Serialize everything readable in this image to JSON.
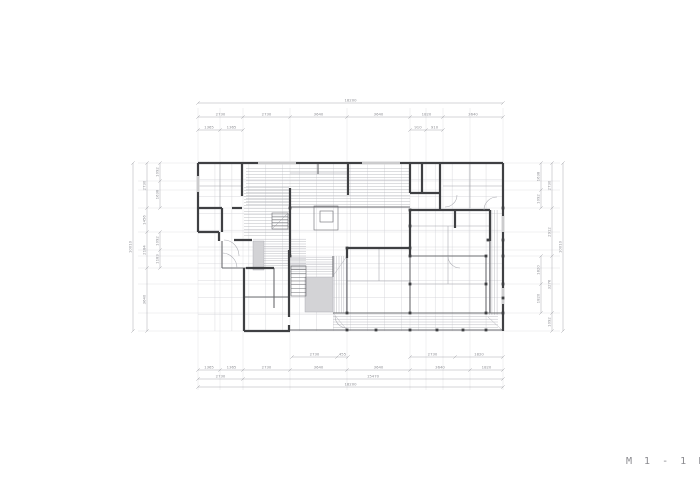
{
  "title": {
    "label": "M 1 - 1 F"
  },
  "colors": {
    "wall": "#3f4043",
    "medium": "#6b6c70",
    "thin": "#a3a4aa",
    "grid": "#cfd0d6",
    "ext": "#dcdce0",
    "hatch": "#b3b4ba",
    "gray_fill": "#d3d3d6",
    "dim": "#a0a1a7",
    "dim_text": "#8e8f95",
    "arc": "#a8a9af",
    "bg": "#ffffff"
  },
  "plan": {
    "grid": {
      "x0": 198,
      "y0": 163,
      "x1": 503,
      "y1": 331,
      "cols": 18,
      "rows": 10
    },
    "ext": {
      "xs": [
        198,
        220,
        243,
        290,
        347,
        410,
        426,
        443,
        470,
        503
      ],
      "ys": [
        163,
        181,
        190,
        208,
        232,
        250,
        256,
        268,
        284,
        313,
        331
      ],
      "ytop": 108,
      "ybot": 390,
      "xleft": 138,
      "xright": 560
    },
    "walls": [
      [
        198,
        163,
        503,
        163
      ],
      [
        198,
        163,
        198,
        232
      ],
      [
        198,
        232,
        219,
        232
      ],
      [
        219,
        232,
        219,
        241
      ],
      [
        234,
        240,
        252,
        240
      ],
      [
        244,
        268,
        244,
        331
      ],
      [
        244,
        331,
        290,
        331
      ],
      [
        503,
        163,
        503,
        331
      ],
      [
        242,
        163,
        242,
        196
      ],
      [
        198,
        208,
        222,
        208
      ],
      [
        232,
        208,
        242,
        208
      ],
      [
        222,
        208,
        222,
        232
      ],
      [
        290,
        188,
        290,
        257
      ],
      [
        246,
        268,
        274,
        268
      ],
      [
        289,
        250,
        289,
        317
      ],
      [
        289,
        325,
        289,
        331
      ],
      [
        348,
        163,
        348,
        195
      ],
      [
        410,
        163,
        410,
        193
      ],
      [
        410,
        193,
        440,
        193
      ],
      [
        422,
        163,
        422,
        193
      ],
      [
        440,
        163,
        440,
        210
      ],
      [
        410,
        210,
        490,
        210
      ],
      [
        410,
        210,
        410,
        257
      ],
      [
        455,
        210,
        455,
        228
      ],
      [
        490,
        210,
        490,
        241
      ],
      [
        347,
        248,
        410,
        248
      ],
      [
        347,
        248,
        347,
        258
      ]
    ],
    "medium": [
      [
        318,
        163,
        318,
        174
      ],
      [
        274,
        268,
        274,
        308
      ],
      [
        222,
        241,
        222,
        268
      ],
      [
        222,
        268,
        246,
        268
      ],
      [
        244,
        297,
        289,
        297
      ],
      [
        290,
        330,
        503,
        330
      ],
      [
        333,
        313,
        503,
        313
      ],
      [
        410,
        256,
        486,
        256
      ],
      [
        410,
        256,
        410,
        313
      ],
      [
        486,
        256,
        486,
        313
      ],
      [
        347,
        256,
        347,
        313
      ],
      [
        333,
        256,
        333,
        277
      ],
      [
        290,
        207,
        410,
        207
      ],
      [
        490,
        241,
        490,
        313
      ]
    ],
    "thin": [
      [
        220,
        163,
        220,
        208
      ],
      [
        198,
        186,
        242,
        186
      ],
      [
        443,
        186,
        503,
        186
      ],
      [
        470,
        163,
        470,
        208
      ],
      [
        410,
        226,
        490,
        226
      ],
      [
        448,
        226,
        448,
        256
      ],
      [
        347,
        281,
        410,
        281
      ],
      [
        379,
        248,
        379,
        281
      ],
      [
        410,
        284,
        486,
        284
      ],
      [
        448,
        256,
        448,
        284
      ],
      [
        290,
        173,
        348,
        173
      ]
    ],
    "hatches": [
      {
        "x": 246,
        "y": 167,
        "w": 164,
        "h": 39,
        "dir": "h",
        "gap": 3
      },
      {
        "x": 244,
        "y": 186,
        "w": 45,
        "h": 52,
        "dir": "h",
        "gap": 3
      },
      {
        "x": 253,
        "y": 238,
        "w": 53,
        "h": 31,
        "dir": "h",
        "gap": 2.4
      },
      {
        "x": 289,
        "y": 256,
        "w": 44,
        "h": 20,
        "dir": "h",
        "gap": 2.4
      },
      {
        "x": 333,
        "y": 256,
        "w": 14,
        "h": 57,
        "dir": "v",
        "gap": 2.4
      },
      {
        "x": 333,
        "y": 315,
        "w": 165,
        "h": 15,
        "dir": "h",
        "gap": 2.8
      },
      {
        "x": 488,
        "y": 210,
        "w": 11,
        "h": 105,
        "dir": "v",
        "gap": 2.6
      }
    ],
    "mitres": [
      [
        333,
        276,
        347,
        256
      ],
      [
        333,
        313,
        347,
        330
      ],
      [
        488,
        317,
        502,
        330
      ]
    ],
    "grays": [
      {
        "x": 253,
        "y": 241,
        "w": 11,
        "h": 29
      },
      {
        "x": 305,
        "y": 277,
        "w": 28,
        "h": 35
      }
    ],
    "stairs": {
      "main": {
        "x": 291,
        "y": 266,
        "w": 15,
        "h": 30,
        "steps": 8
      },
      "small": {
        "x": 272,
        "y": 213,
        "w": 16,
        "h": 16,
        "steps": 5
      }
    },
    "squares": [
      {
        "x": 314,
        "y": 206,
        "w": 24,
        "h": 24
      },
      {
        "x": 320,
        "y": 211,
        "w": 13,
        "h": 11
      }
    ],
    "arcs": [
      "M224,240 A15,16 0 0 1 239,256",
      "M222,253 A15,15 0 0 1 237,268",
      "M445,207 A12,12 0 0 0 457,195",
      "M484,210 A13,13 0 0 1 497,197",
      "M448,256 A12,12 0 0 0 460,268",
      "M335,316 A12,12 0 0 0 347,328"
    ],
    "windows": [
      {
        "x": 258,
        "y": 163,
        "len": 38,
        "o": "h"
      },
      {
        "x": 362,
        "y": 163,
        "len": 38,
        "o": "h"
      },
      {
        "x": 198,
        "y": 176,
        "len": 16,
        "o": "v"
      },
      {
        "x": 503,
        "y": 216,
        "len": 16,
        "o": "v"
      },
      {
        "x": 503,
        "y": 288,
        "len": 16,
        "o": "v"
      }
    ],
    "columns": [
      [
        347,
        248
      ],
      [
        410,
        248
      ],
      [
        410,
        210
      ],
      [
        410,
        226
      ],
      [
        410,
        256
      ],
      [
        410,
        284
      ],
      [
        410,
        313
      ],
      [
        410,
        330
      ],
      [
        437,
        330
      ],
      [
        463,
        330
      ],
      [
        486,
        256
      ],
      [
        486,
        284
      ],
      [
        486,
        313
      ],
      [
        486,
        330
      ],
      [
        503,
        208
      ],
      [
        503,
        240
      ],
      [
        503,
        256
      ],
      [
        503,
        284
      ],
      [
        503,
        313
      ],
      [
        503,
        298
      ],
      [
        347,
        313
      ],
      [
        347,
        330
      ],
      [
        376,
        330
      ],
      [
        290,
        208
      ],
      [
        290,
        256
      ],
      [
        488,
        240
      ]
    ]
  },
  "dims": {
    "chains": [
      {
        "o": "h",
        "pos": 103,
        "ticks": [
          198,
          503
        ],
        "labels": [
          "18200"
        ]
      },
      {
        "o": "h",
        "pos": 117,
        "ticks": [
          198,
          243,
          290,
          347,
          410,
          443,
          503
        ],
        "labels": [
          "2730",
          "2730",
          "3640",
          "3640",
          "1820",
          "3640"
        ]
      },
      {
        "o": "h",
        "pos": 130,
        "ticks": [
          198,
          220,
          243
        ],
        "labels": [
          "1365",
          "1365"
        ]
      },
      {
        "o": "h",
        "pos": 130,
        "ticks": [
          410,
          426,
          443
        ],
        "labels": [
          "910",
          "910"
        ]
      },
      {
        "o": "h",
        "pos": 357,
        "ticks": [
          292,
          337,
          348
        ],
        "labels": [
          "2730",
          "455"
        ]
      },
      {
        "o": "h",
        "pos": 357,
        "ticks": [
          410,
          455,
          503
        ],
        "labels": [
          "2730",
          "1820"
        ]
      },
      {
        "o": "h",
        "pos": 370,
        "ticks": [
          198,
          220,
          243,
          290,
          347,
          410,
          470,
          503
        ],
        "labels": [
          "1365",
          "1365",
          "2730",
          "3640",
          "3640",
          "3640",
          "1820"
        ]
      },
      {
        "o": "h",
        "pos": 379,
        "ticks": [
          198,
          243,
          503
        ],
        "labels": [
          "2730",
          "15470"
        ]
      },
      {
        "o": "h",
        "pos": 387,
        "ticks": [
          198,
          503
        ],
        "labels": [
          "18200"
        ]
      },
      {
        "o": "v",
        "pos": 160,
        "ticks": [
          163,
          181,
          208
        ],
        "labels": [
          "1092",
          "1638"
        ]
      },
      {
        "o": "v",
        "pos": 160,
        "ticks": [
          232,
          250,
          268
        ],
        "labels": [
          "1092",
          "1183"
        ]
      },
      {
        "o": "v",
        "pos": 147,
        "ticks": [
          163,
          208,
          232,
          268,
          331
        ],
        "labels": [
          "2730",
          "1456",
          "2184",
          "3640"
        ]
      },
      {
        "o": "v",
        "pos": 133,
        "ticks": [
          163,
          331
        ],
        "labels": [
          "10010"
        ]
      },
      {
        "o": "v",
        "pos": 541,
        "ticks": [
          163,
          190,
          208
        ],
        "labels": [
          "1638",
          "1092"
        ]
      },
      {
        "o": "v",
        "pos": 541,
        "ticks": [
          256,
          284,
          313
        ],
        "labels": [
          "1820",
          "1820"
        ]
      },
      {
        "o": "v",
        "pos": 552,
        "ticks": [
          163,
          208,
          256,
          313,
          331
        ],
        "labels": [
          "2730",
          "2912",
          "3276",
          "1092"
        ]
      },
      {
        "o": "v",
        "pos": 563,
        "ticks": [
          163,
          331
        ],
        "labels": [
          "10010"
        ]
      }
    ]
  }
}
